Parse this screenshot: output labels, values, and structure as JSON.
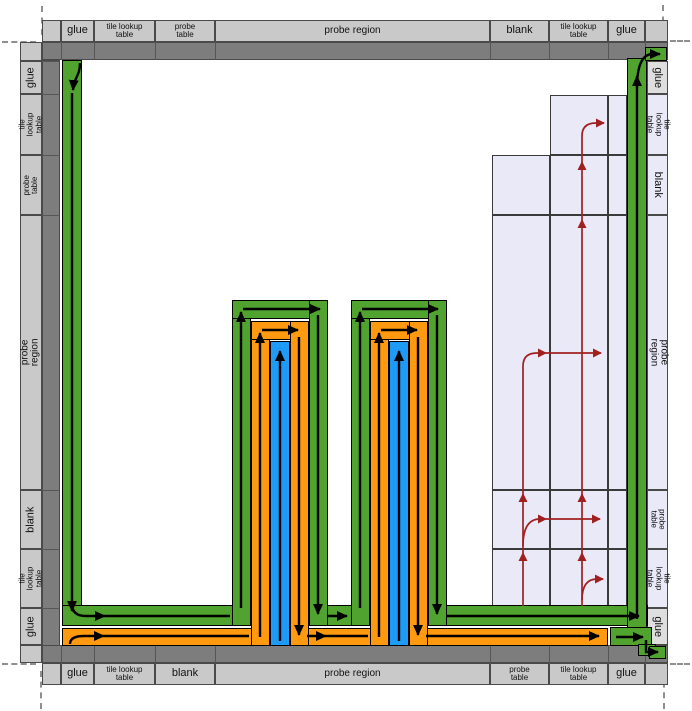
{
  "frame": {
    "top": [
      "glue",
      "tile lookup\ntable",
      "probe\ntable",
      "probe region",
      "blank",
      "tile lookup\ntable",
      "glue"
    ],
    "bottom": [
      "glue",
      "tile lookup\ntable",
      "blank",
      "probe region",
      "probe\ntable",
      "tile lookup\ntable",
      "glue"
    ],
    "left": [
      "glue",
      "tile lookup\ntable",
      "probe\ntable",
      "probe region",
      "blank",
      "tile lookup\ntable",
      "glue"
    ],
    "right": [
      "glue",
      "tile lookup\ntable",
      "blank",
      "probe region",
      "probe\ntable",
      "tile lookup\ntable",
      "glue"
    ]
  },
  "colors": {
    "green_path": "#4fa32e",
    "orange_path": "#ff9a10",
    "blue_path": "#1e9bf7",
    "lavender_region": "#e9e9f8",
    "frame_dark": "#7d7d7d",
    "frame_light": "#c9c9c9",
    "red_arrow": "#a02020"
  }
}
